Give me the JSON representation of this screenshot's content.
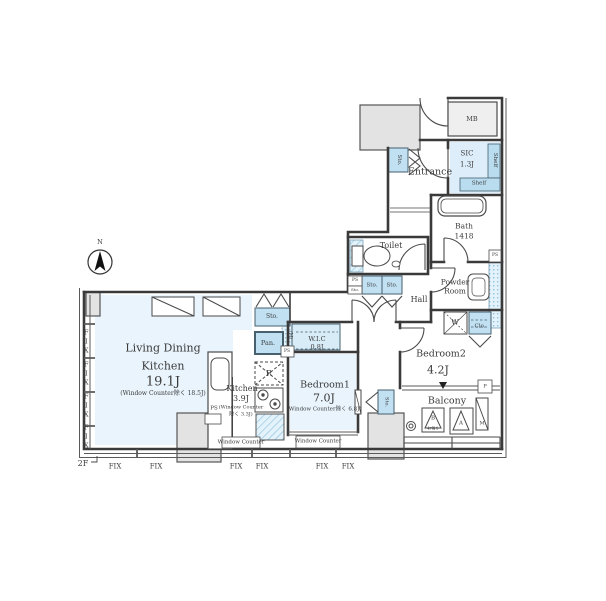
{
  "floor": {
    "label": "2F"
  },
  "compass": {
    "north": "N"
  },
  "rooms": {
    "ldk": {
      "line1": "Living Dining",
      "line2": "Kitchen",
      "size": "19.1J",
      "note": "(Window Counter除く 18.5J)"
    },
    "kitchen": {
      "name": "Kitchen",
      "size": "3.9J",
      "note1": "(Window Counter",
      "note2": "除く 3.3J)"
    },
    "bedroom1": {
      "name": "Bedroom1",
      "size": "7.0J",
      "note": "(Window Counter除く 6.8J)"
    },
    "bedroom2": {
      "name": "Bedroom2",
      "size": "4.2J"
    },
    "wic": {
      "name": "W.I.C",
      "size": "0.8J"
    },
    "hall": {
      "name": "Hall"
    },
    "toilet": {
      "name": "Toilet"
    },
    "bath": {
      "name": "Bath",
      "size": "1418"
    },
    "powder": {
      "line1": "Powder",
      "line2": "Room"
    },
    "entrance": {
      "name": "Entrance"
    },
    "sic": {
      "name": "SIC",
      "size": "1.3J"
    },
    "balcony": {
      "name": "Balcony"
    },
    "mb": {
      "name": "MB"
    }
  },
  "storage": {
    "sto": "Sto.",
    "pan": "Pan.",
    "shelf": "Shelf",
    "closet": "Clo.",
    "washer": "W",
    "fridge": "R"
  },
  "service": {
    "ps": "PS",
    "meter": "(M)",
    "pipe": "P"
  },
  "windows": {
    "fix": "FIX",
    "counter": "Window Counter"
  },
  "balcony_marks": {
    "b": "B",
    "b_note": "4F降り",
    "a": "A",
    "m": "M"
  },
  "colors": {
    "room_fill": "#e9f4fc",
    "closet_fill": "#c1e1f3",
    "wic_fill": "#d8ecf8",
    "column_fill": "#e3e3e3",
    "wall": "#3a3a3a",
    "hatch_line": "#8bc0da"
  }
}
